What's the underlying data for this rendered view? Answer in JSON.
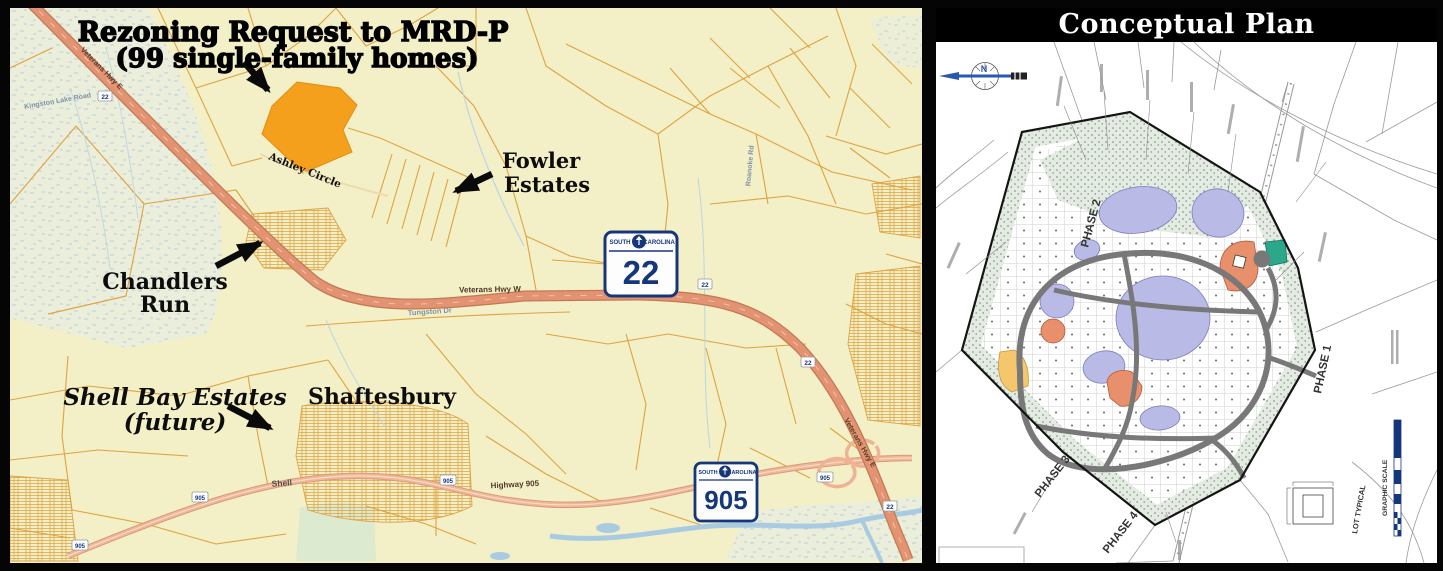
{
  "left_map": {
    "title_line1": "Rezoning Request to MRD-P",
    "title_line2": "(99 single-family homes)",
    "labels": {
      "fowler_line1": "Fowler",
      "fowler_line2": "Estates",
      "chandlers_line1": "Chandlers",
      "chandlers_line2": "Run",
      "shellbay_line1": "Shell Bay Estates",
      "shellbay_line2": "(future)",
      "shaftesbury": "Shaftesbury",
      "ashley_circle": "Ashley Circle"
    },
    "roads": {
      "veterans_hwy_w": "Veterans Hwy W",
      "veterans_hwy_e": "Veterans Hwy E",
      "tungston_dr": "Tungston Dr",
      "roanoke_rd": "Roanoke Rd",
      "kingston_lake_rd": "Kingston Lake Road",
      "shell": "Shell",
      "highway_905": "Highway 905"
    },
    "shield_22": {
      "state_left": "SOUTH",
      "state_right": "CAROLINA",
      "number": "22"
    },
    "shield_905": {
      "state_left": "SOUTH",
      "state_right": "CAROLINA",
      "number": "905"
    },
    "marker_22": "22",
    "marker_905": "905"
  },
  "right_panel": {
    "title": "Conceptual Plan",
    "compass_north": "N",
    "phase_1": "PHASE 1",
    "phase_2": "PHASE 2",
    "phase_3": "PHASE 3",
    "phase_4": "PHASE 4",
    "lot_typical": "LOT TYPICAL",
    "graphic_scale": "GRAPHIC SCALE"
  },
  "colors": {
    "map_background": "#F3EFC7",
    "parcel_line": "#DFA33F",
    "highway_salmon": "#E39272",
    "rezoning_site_orange": "#F5A01D",
    "shield_blue": "#16367C",
    "pond_lavender": "#BABAE6",
    "buffer_green": "#E3EBE2",
    "amenity_salmon": "#E8906C",
    "amenity_teal": "#2BA88A",
    "amenity_yellow": "#F4C76D"
  }
}
